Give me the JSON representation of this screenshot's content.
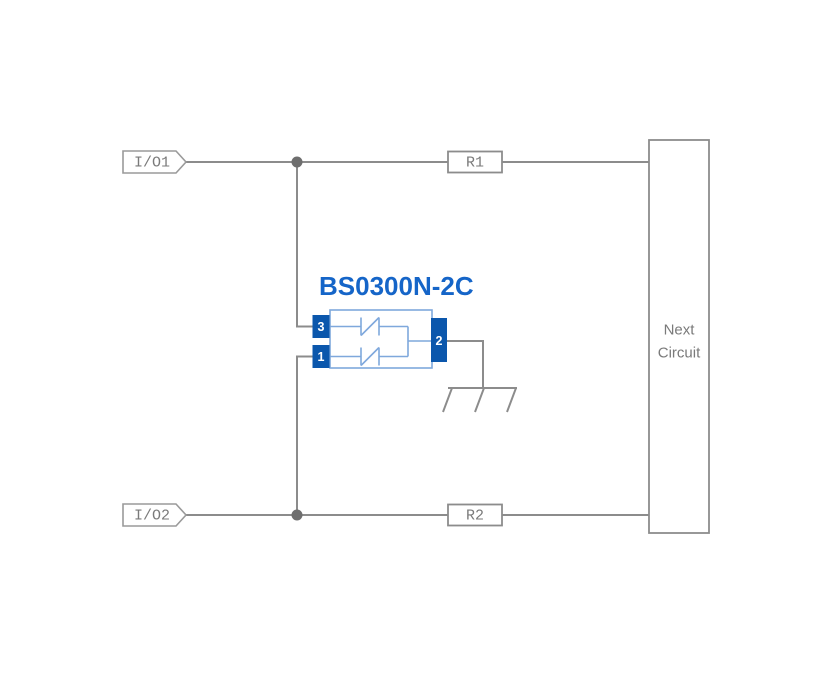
{
  "diagram": {
    "terminals": {
      "io1": "I/O1",
      "io2": "I/O2"
    },
    "resistors": {
      "r1": "R1",
      "r2": "R2"
    },
    "component": {
      "title": "BS0300N-2C",
      "pins": {
        "p1": "1",
        "p2": "2",
        "p3": "3"
      }
    },
    "next_circuit": {
      "line1": "Next",
      "line2": "Circuit"
    }
  },
  "colors": {
    "wire": "#8C8C8C",
    "label-text": "#7A7A7A",
    "junction": "#6E6E6E",
    "component-accent": "#1565C8",
    "pin-fill": "#0B57AC",
    "body-stroke": "#7FA8DC",
    "pin-text": "#FFFFFF",
    "background": "#FFFFFF"
  }
}
